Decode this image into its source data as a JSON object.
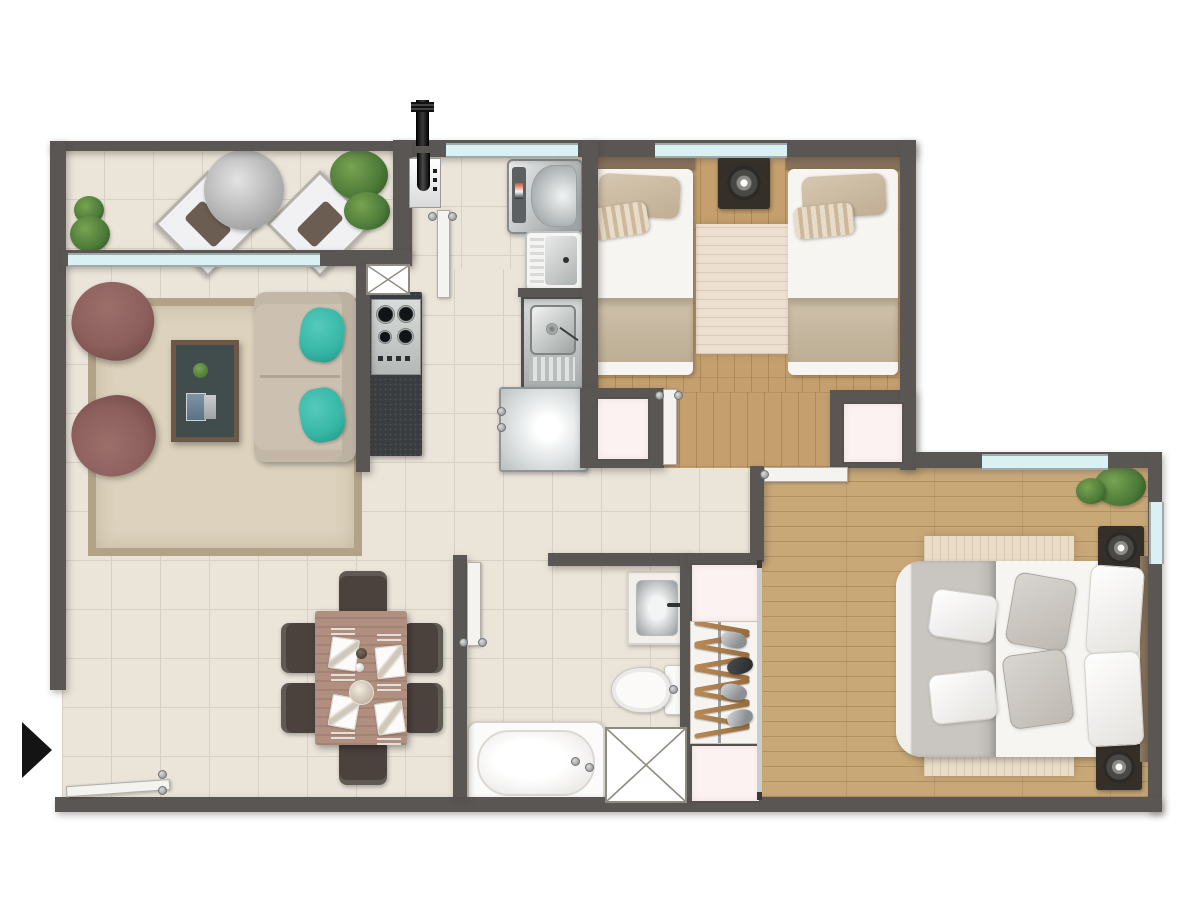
{
  "meta": {
    "type": "apartment-floor-plan",
    "view": "top-down-render",
    "canvas_width": 1200,
    "canvas_height": 900,
    "visible_text": "none"
  },
  "colors": {
    "wall": "#5a5653",
    "tile": "#eae4d9",
    "tileLine": "#d8d0c2",
    "wood": "#c5a06e",
    "woodMaster": "#c9a878",
    "glass": "#d9f1f2",
    "frame": "#a3a8a8",
    "pink": "#fbf2f1",
    "counter": "#3a3d40",
    "steel": "#c6c9c7",
    "rug": "#dcd2bd",
    "rugBorder": "#b2a288",
    "armchair": "#8c5f5c",
    "sofa": "#ccc1b0",
    "teal": "#36b6a6",
    "ctableTop": "#414c4d",
    "ctableEdge": "#6c5847",
    "diningTable": "#b08f81",
    "chair": "#4b423d",
    "bedWhite": "#f7f5f2",
    "headboard": "#88725a",
    "blanketBeige": "#c9bba3",
    "blanketGray": "#c9c5c1",
    "nightstand": "#352f2a",
    "rugBed": "#e9dcc8",
    "plant": "#4c7a38",
    "black": "#141414",
    "door": "#f4f3f0"
  },
  "rooms": [
    {
      "id": "balcony",
      "floor": "tile",
      "furniture": [
        "round-bistro-table",
        "lounge-chair",
        "lounge-chair",
        "plant",
        "plant",
        "plant"
      ]
    },
    {
      "id": "living-room",
      "floor": "tile",
      "furniture": [
        "armchair",
        "armchair",
        "two-seat-sofa",
        "teal-cushion",
        "teal-cushion",
        "coffee-table",
        "area-rug"
      ]
    },
    {
      "id": "kitchen-laundry",
      "floor": "tile",
      "furniture": [
        "granite-counter",
        "gas-cooktop-4-burner",
        "water-heater",
        "washing-machine",
        "laundry-tub",
        "kitchen-sink",
        "refrigerator",
        "service-shaft"
      ]
    },
    {
      "id": "bedroom-2",
      "floor": "wood",
      "furniture": [
        "single-bed",
        "single-bed",
        "nightstand-with-lamp",
        "rug",
        "closet",
        "closet",
        "window"
      ]
    },
    {
      "id": "master-bedroom",
      "floor": "wood",
      "furniture": [
        "double-bed",
        "gray-throw-blanket",
        "pillows",
        "nightstand-with-lamp",
        "nightstand-with-lamp",
        "area-rug",
        "plant",
        "window",
        "window"
      ]
    },
    {
      "id": "wardrobe",
      "floor": "none",
      "furniture": [
        "upper-cabinet",
        "hanging-rail-with-clothes",
        "lower-cabinet",
        "sliding-door"
      ]
    },
    {
      "id": "bathroom",
      "floor": "tile",
      "furniture": [
        "vanity-sink",
        "toilet",
        "bathtub",
        "service-shaft"
      ]
    },
    {
      "id": "dining-area",
      "floor": "tile",
      "furniture": [
        "dining-table",
        "chair",
        "chair",
        "chair",
        "chair",
        "chair",
        "chair",
        "place-setting-x4"
      ]
    }
  ],
  "wardrobe": {
    "hangers": 10,
    "clothes_blobs": 4
  },
  "doors": [
    "entry-door",
    "balcony-kitchen-door",
    "bedroom-2-door",
    "master-bedroom-door",
    "bathroom-door"
  ],
  "windows": [
    "balcony-living-window",
    "laundry-window",
    "bedroom-2-window",
    "master-top-window",
    "master-side-window"
  ],
  "entrance_marker": {
    "shape": "triangle-arrow",
    "direction": "right",
    "color": "#141414"
  }
}
